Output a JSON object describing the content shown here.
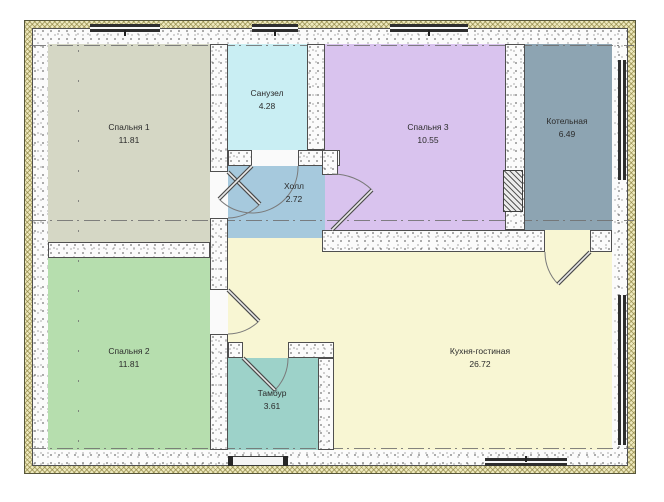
{
  "plan": {
    "title": "floor-plan",
    "rooms": [
      {
        "name": "Спальня 1",
        "area": "11.81",
        "color": "#d5d7c5"
      },
      {
        "name": "Санузел",
        "area": "4.28",
        "color": "#c9eef3"
      },
      {
        "name": "Спальня 3",
        "area": "10.55",
        "color": "#d9c3ee"
      },
      {
        "name": "Котельная",
        "area": "6.49",
        "color": "#8da4b2"
      },
      {
        "name": "Холл",
        "area": "2.72",
        "color": "#a6c9dd"
      },
      {
        "name": "Спальня 2",
        "area": "11.81",
        "color": "#b6deae"
      },
      {
        "name": "Тамбур",
        "area": "3.61",
        "color": "#9dd2c9"
      },
      {
        "name": "Кухня-гостиная",
        "area": "26.72",
        "color": "#f8f6d3"
      }
    ],
    "wall_colors": {
      "insulation_hatch": "#ede8bc",
      "masonry_speckle": "#fbfbfb",
      "outline": "#4f4f4f"
    },
    "window_color": "#2e2e2e",
    "axis_color": "#6f6f6f"
  }
}
